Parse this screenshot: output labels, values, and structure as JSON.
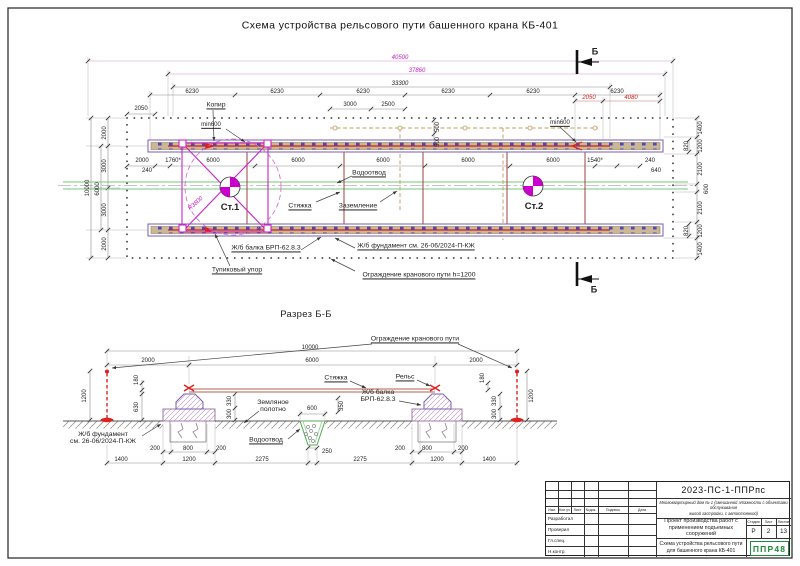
{
  "page": {
    "title": "Схема устройства рельсового пути башенного крана КБ-401"
  },
  "colors": {
    "magenta": "#c320c3",
    "red_dim": "#cf2020",
    "rail_red": "#cc2222",
    "drain_green": "#79c879",
    "ground_tan": "#c89858",
    "logo_green": "#1e8a3c"
  },
  "plan": {
    "dims": {
      "total": "40500",
      "axis": "37860",
      "rail_len": "33300",
      "seg6230": "6230",
      "left2050": "2050",
      "mid3000": "3000",
      "mid2500": "2500",
      "off500": "500",
      "right2050": "2050",
      "right4080": "4080",
      "min600": "min600",
      "d2000": "2000",
      "d240": "240",
      "d1760": "1760*",
      "d6000": "6000",
      "d1540": "1540*",
      "d640": "640",
      "left10000": "10000",
      "left2000": "2000",
      "left3000": "3000",
      "left6000": "6000",
      "r1400": "1400",
      "r1200": "1200",
      "r820": "820",
      "r2100": "2100",
      "r600": "600"
    },
    "labels": {
      "kopir": "Копир",
      "vodootvod": "Водоотвод",
      "styazhka": "Стяжка",
      "zazemlenie": "Заземление",
      "st1": "Ст.1",
      "st2": "Ст.2",
      "r3800": "R3800",
      "balka": "Ж/б балка БРП-62.8.3",
      "fundament": "Ж/б фундамент см. 26-06/2024-П-КЖ",
      "tupik": "Тупиковый упор",
      "ograzhdenie": "Ограждение кранового пути h=1200",
      "section_mark": "Б"
    }
  },
  "section": {
    "title": "Разрез Б-Б",
    "labels": {
      "ograzhdenie": "Ограждение кранового пути",
      "styazhka": "Стяжка",
      "rels": "Рельс",
      "balka": "Ж/б балка\nБРП-62.8.3",
      "zemlyanoe": "Земляное\nполотно",
      "vodootvod": "Водоотвод",
      "fundament": "Ж/б фундамент\nсм. 26-06/2024-П-КЖ"
    },
    "dims": {
      "d10000": "10000",
      "d2000": "2000",
      "d6000": "6000",
      "d600": "600",
      "d350": "350",
      "d250": "250",
      "d200": "200",
      "d800": "800",
      "d1400": "1400",
      "d1200": "1200",
      "d2275": "2275",
      "d180": "180",
      "d630": "630",
      "d330": "330",
      "d300": "300"
    }
  },
  "titleblock": {
    "doc_number": "2023-ПС-1-ППРпс",
    "project_desc": "Многоквартирный дом № 1 (смешанной этажности с объектами обслуживания\nжилой застройки, с автостоянкой)",
    "work_title": "Проект производства работ с\nприменением подъемных сооружений",
    "sheet_title": "Схема устройства рельсового пути\nдля башенного крана КБ-401",
    "stage_label": "Стадия",
    "sheet_label": "Лист",
    "sheets_label": "Листов",
    "stage": "Р",
    "sheet": "2",
    "sheets": "13",
    "logo": "ППР48",
    "header_cols": [
      "Изм.",
      "Кол.уч",
      "Лист",
      "№док.",
      "Подпись",
      "Дата"
    ],
    "rows": [
      "Разработал",
      "Проверил",
      "Гл.спец.",
      "Н.контр."
    ]
  }
}
